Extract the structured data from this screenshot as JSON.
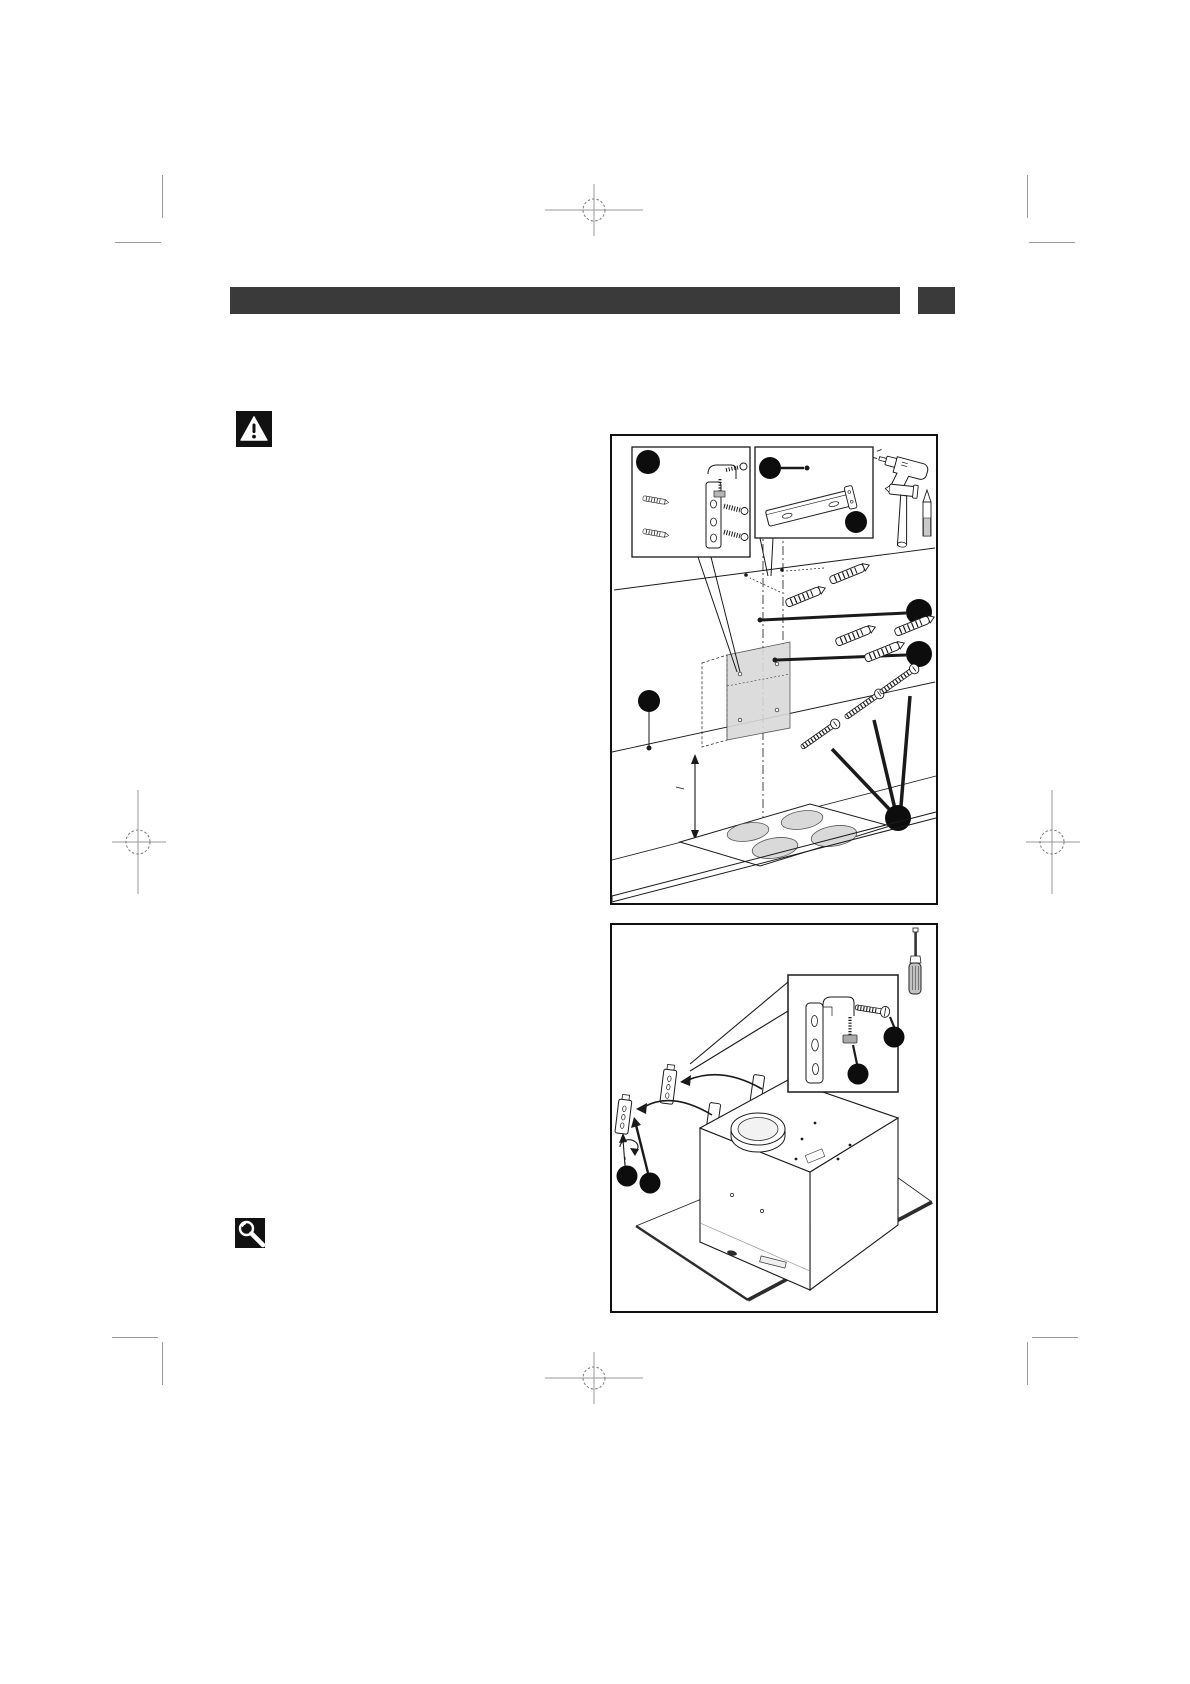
{
  "page": {
    "type": "installation-manual-page",
    "background": "#ffffff",
    "visible_text": ""
  },
  "header": {
    "bar_label": "",
    "bar_color": "#3a3a3a",
    "corner_tab_color": "#3a3a3a"
  },
  "icons": {
    "warning": {
      "name": "warning-triangle-icon",
      "background": "#111111",
      "glyph_color": "#ffffff"
    },
    "magnifier": {
      "name": "magnifying-glass-icon",
      "background": "#111111",
      "glyph_color": "#ffffff"
    }
  },
  "figures": {
    "figure1": {
      "subject": "marking-and-drilling-wall-for-hood-mounting",
      "callout_badge_count": 7,
      "tools_shown": [
        "drill",
        "hammer",
        "pencil"
      ],
      "parts_shown": [
        "fixing-bracket-with-screws-and-plugs",
        "mounting-rail",
        "drilling-template",
        "wall-plugs",
        "screws",
        "cooktop-with-four-burners"
      ]
    },
    "figure2": {
      "subject": "attaching-fixing-brackets-to-hood-body",
      "callout_badge_count": 4,
      "tools_shown": [
        "screwdriver"
      ],
      "parts_shown": [
        "fixing-brackets",
        "clamp-screw",
        "hood-body-with-outlet-collar",
        "glass-panel"
      ]
    }
  },
  "colors": {
    "ink": "#1a1a1a",
    "badge": "#0d0d0d",
    "fill_gray": "#d9d9d9",
    "crop_mark": "#9a9a9a",
    "page_bg": "#ffffff",
    "bar": "#3a3a3a"
  }
}
